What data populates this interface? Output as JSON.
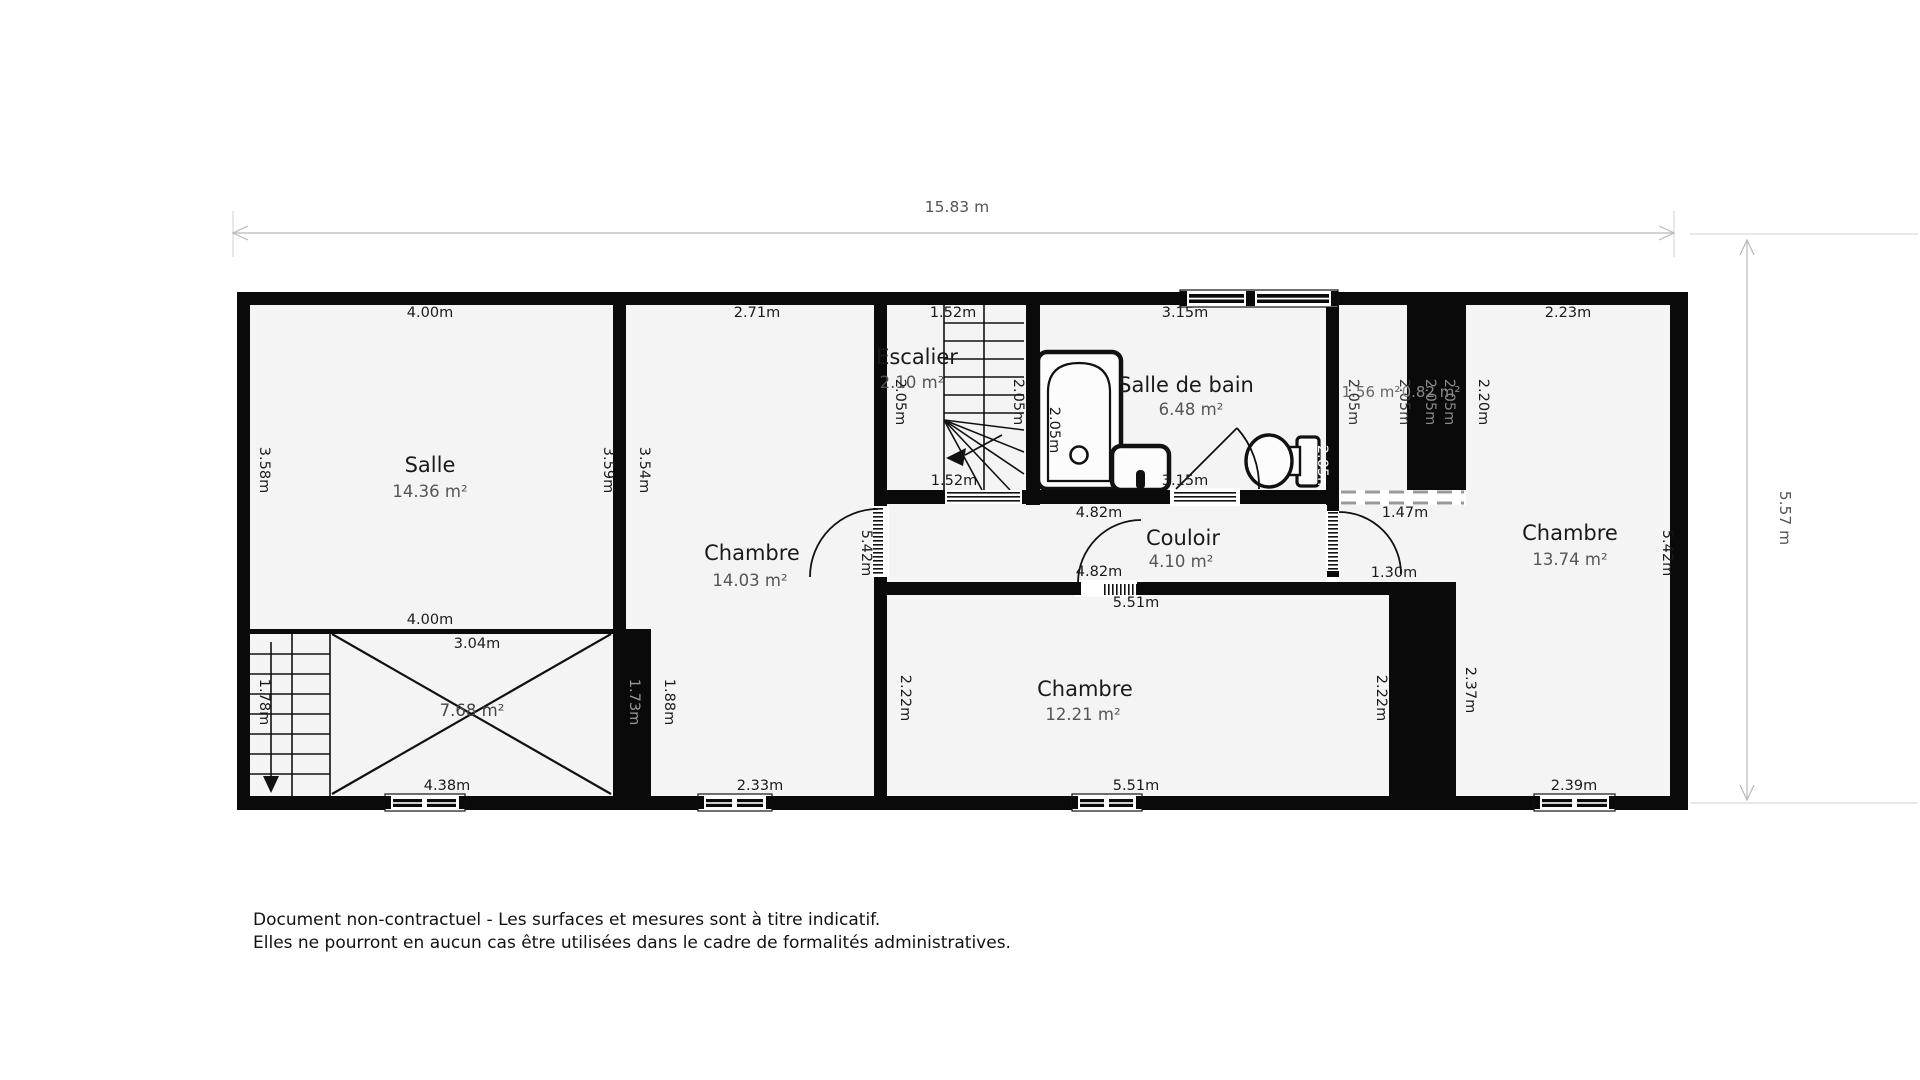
{
  "document": {
    "type_label": "floor-plan",
    "disclaimer": {
      "line1": "Document non-contractuel - Les surfaces et mesures sont à titre indicatif.",
      "line2": "Elles ne pourront en aucun cas être utilisées dans le cadre de formalités administratives."
    }
  },
  "colors": {
    "wall": "#0a0a0a",
    "floor": "#f4f4f4",
    "dim_line": "#b9b9b9",
    "dim_text": "#555555",
    "muted_label": "#999999",
    "area_text": "#555555"
  },
  "overall_dimensions": {
    "width_label": "15.83 m",
    "height_label": "5.57 m"
  },
  "rooms": [
    {
      "name": "Salle",
      "area": "14.36 m²",
      "measurements": [
        "4.00m",
        "4.00m",
        "3.58m",
        "3.59m"
      ]
    },
    {
      "name": "Chambre",
      "area": "14.03 m²",
      "measurements": [
        "2.71m",
        "3.54m",
        "5.42m",
        "2.33m",
        "1.88m",
        "1.73m"
      ]
    },
    {
      "name": "Escalier",
      "area": "2.10 m²",
      "measurements": [
        "1.52m",
        "1.52m",
        "2.05m",
        "2.05m"
      ]
    },
    {
      "name": "Salle de bain",
      "area": "6.48 m²",
      "measurements": [
        "3.15m",
        "3.15m",
        "2.05m",
        "2.05m"
      ]
    },
    {
      "name": "Couloir",
      "area": "4.10 m²",
      "measurements": [
        "4.82m",
        "4.82m",
        "1.30m",
        "1.47m"
      ]
    },
    {
      "name": "Chambre",
      "area": "12.21 m²",
      "measurements": [
        "5.51m",
        "5.51m",
        "2.22m",
        "2.22m"
      ]
    },
    {
      "name": "Chambre",
      "area": "13.74 m²",
      "measurements": [
        "2.23m",
        "2.20m",
        "5.42m",
        "2.37m",
        "2.39m"
      ]
    },
    {
      "name": "",
      "area": "1.56 m²",
      "measurements": [
        "2.05m",
        "2.05m"
      ]
    },
    {
      "name": "",
      "area": "0.82 m²",
      "measurements": [
        "2.05m",
        "2.05m"
      ]
    },
    {
      "name": "",
      "area": "7.68 m²",
      "measurements": [
        "3.04m",
        "4.38m",
        "1.78m"
      ]
    }
  ],
  "plan": {
    "labels": [
      {
        "t": "15.83 m",
        "x": 957,
        "y": 212,
        "s": 15.5,
        "c": "#555555"
      },
      {
        "t": "5.57 m",
        "x": 1780,
        "y": 518,
        "r": 90,
        "s": 15.5,
        "c": "#555555"
      },
      {
        "t": "Salle",
        "x": 430,
        "y": 472,
        "s": 21
      },
      {
        "t": "14.36 m²",
        "x": 430,
        "y": 497,
        "s": 16.5,
        "c": "#555555"
      },
      {
        "t": "4.00m",
        "x": 430,
        "y": 317
      },
      {
        "t": "4.00m",
        "x": 430,
        "y": 624
      },
      {
        "t": "3.58m",
        "x": 260,
        "y": 470,
        "r": 90
      },
      {
        "t": "3.59m",
        "x": 604,
        "y": 470,
        "r": 90
      },
      {
        "t": "Chambre",
        "x": 752,
        "y": 560,
        "s": 21
      },
      {
        "t": "14.03 m²",
        "x": 750,
        "y": 586,
        "s": 16.5,
        "c": "#555555"
      },
      {
        "t": "2.71m",
        "x": 757,
        "y": 317
      },
      {
        "t": "3.54m",
        "x": 640,
        "y": 470,
        "r": 90
      },
      {
        "t": "5.42m",
        "x": 862,
        "y": 553,
        "r": 90
      },
      {
        "t": "1.73m",
        "x": 630,
        "y": 702,
        "r": 90,
        "c": "#999999"
      },
      {
        "t": "1.88m",
        "x": 665,
        "y": 702,
        "r": 90
      },
      {
        "t": "2.33m",
        "x": 760,
        "y": 790
      },
      {
        "t": "3.04m",
        "x": 477,
        "y": 648
      },
      {
        "t": "7.68 m²",
        "x": 472,
        "y": 716,
        "s": 16.5,
        "c": "#444444"
      },
      {
        "t": "1.78m",
        "x": 260,
        "y": 702,
        "r": 90
      },
      {
        "t": "4.38m",
        "x": 447,
        "y": 790
      },
      {
        "t": "Escalier",
        "x": 917,
        "y": 364,
        "s": 21
      },
      {
        "t": "2.10 m²",
        "x": 912,
        "y": 388,
        "s": 16.5,
        "c": "#555555"
      },
      {
        "t": "1.52m",
        "x": 953,
        "y": 317
      },
      {
        "t": "1.52m",
        "x": 954,
        "y": 485
      },
      {
        "t": "2.05m",
        "x": 896,
        "y": 402,
        "r": 90
      },
      {
        "t": "2.05m",
        "x": 1014,
        "y": 402,
        "r": 90
      },
      {
        "t": "Salle de bain",
        "x": 1186,
        "y": 392,
        "s": 21
      },
      {
        "t": "6.48 m²",
        "x": 1191,
        "y": 415,
        "s": 16.5,
        "c": "#555555"
      },
      {
        "t": "3.15m",
        "x": 1185,
        "y": 317
      },
      {
        "t": "3.15m",
        "x": 1185,
        "y": 485
      },
      {
        "t": "2.05m",
        "x": 1050,
        "y": 430,
        "r": 90
      },
      {
        "t": "2.05m",
        "x": 1318,
        "y": 468,
        "r": 90,
        "c": "#ffffff"
      },
      {
        "t": "1.56 m²",
        "x": 1371,
        "y": 397,
        "s": 15,
        "c": "#666666"
      },
      {
        "t": "2.05m",
        "x": 1349,
        "y": 402,
        "r": 90,
        "c": "#333333"
      },
      {
        "t": "2.05m",
        "x": 1400,
        "y": 402,
        "r": 90,
        "c": "#333333"
      },
      {
        "t": "0.82 m²",
        "x": 1431,
        "y": 397,
        "s": 15,
        "c": "#888888"
      },
      {
        "t": "2.05m",
        "x": 1426,
        "y": 402,
        "r": 90,
        "c": "#888888"
      },
      {
        "t": "2.05m",
        "x": 1445,
        "y": 402,
        "r": 90,
        "c": "#888888"
      },
      {
        "t": "Chambre",
        "x": 1570,
        "y": 540,
        "s": 21
      },
      {
        "t": "13.74 m²",
        "x": 1570,
        "y": 565,
        "s": 16.5,
        "c": "#555555"
      },
      {
        "t": "2.23m",
        "x": 1568,
        "y": 317
      },
      {
        "t": "2.20m",
        "x": 1479,
        "y": 402,
        "r": 90
      },
      {
        "t": "5.42m",
        "x": 1663,
        "y": 553,
        "r": 90
      },
      {
        "t": "2.37m",
        "x": 1466,
        "y": 690,
        "r": 90
      },
      {
        "t": "2.39m",
        "x": 1574,
        "y": 790
      },
      {
        "t": "1.47m",
        "x": 1405,
        "y": 517
      },
      {
        "t": "1.30m",
        "x": 1394,
        "y": 577
      },
      {
        "t": "Couloir",
        "x": 1183,
        "y": 545,
        "s": 21
      },
      {
        "t": "4.10 m²",
        "x": 1181,
        "y": 567,
        "s": 16.5,
        "c": "#555555"
      },
      {
        "t": "4.82m",
        "x": 1099,
        "y": 517
      },
      {
        "t": "4.82m",
        "x": 1099,
        "y": 576
      },
      {
        "t": "Chambre",
        "x": 1085,
        "y": 696,
        "s": 21
      },
      {
        "t": "12.21 m²",
        "x": 1083,
        "y": 720,
        "s": 16.5,
        "c": "#555555"
      },
      {
        "t": "5.51m",
        "x": 1136,
        "y": 607
      },
      {
        "t": "5.51m",
        "x": 1136,
        "y": 790
      },
      {
        "t": "2.22m",
        "x": 901,
        "y": 698,
        "r": 90
      },
      {
        "t": "2.22m",
        "x": 1377,
        "y": 698,
        "r": 90
      }
    ]
  }
}
